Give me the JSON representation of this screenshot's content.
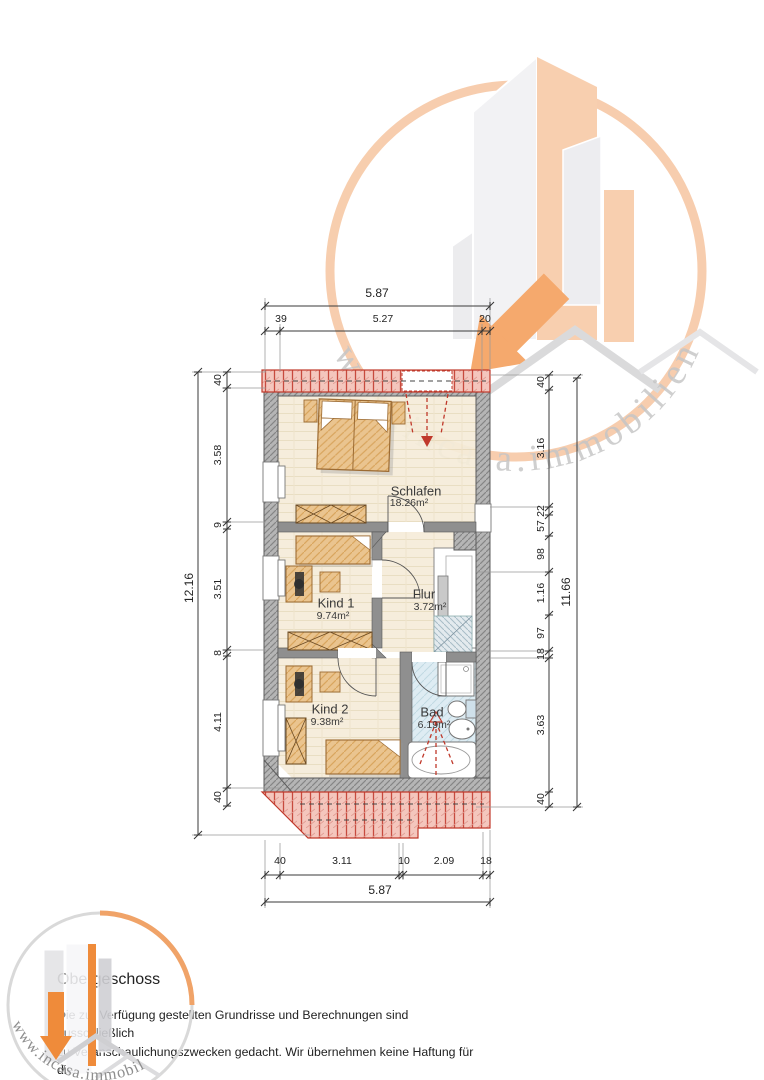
{
  "watermark": {
    "text": "www.incasa.immobilien"
  },
  "footer": {
    "title": "Obergeschoss",
    "disclaimer_lines": [
      "Die zur Verfügung gestellten Grundrisse und Berechnungen sind ausschließlich",
      "zu Veranschaulichungszwecken gedacht. Wir übernehmen keine Haftung für die",
      "Genauigkeit oder Vollständigkeit dieser Angaben."
    ]
  },
  "rooms": [
    {
      "name": "Schlafen",
      "area": "18.26m²"
    },
    {
      "name": "Kind 1",
      "area": "9.74m²"
    },
    {
      "name": "Flur",
      "area": "3.72m²"
    },
    {
      "name": "Kind 2",
      "area": "9.38m²"
    },
    {
      "name": "Bad",
      "area": "6.19m²"
    }
  ],
  "dimensions": {
    "top_total": "5.87",
    "top_chain": [
      "39",
      "5.27",
      "20"
    ],
    "left_total": "12.16",
    "left_chain": [
      "40",
      "3.58",
      "9",
      "3.51",
      "8",
      "4.11",
      "40"
    ],
    "right_total": "11.66",
    "right_chain": [
      "40",
      "3.16",
      "22",
      "57",
      "98",
      "1.16",
      "97",
      "18",
      "3.63",
      "40"
    ],
    "bottom_chain": [
      "40",
      "3.11",
      "10",
      "2.09",
      "18"
    ],
    "bottom_total": "5.87"
  },
  "colors": {
    "accent_orange": "#ef8b3a",
    "peach": "#f8cdab",
    "hatch_red": "#c0392b",
    "room_floor": "#f5ecd9",
    "bath_floor": "#dcebf2",
    "furniture_wood": "#eac48f"
  }
}
